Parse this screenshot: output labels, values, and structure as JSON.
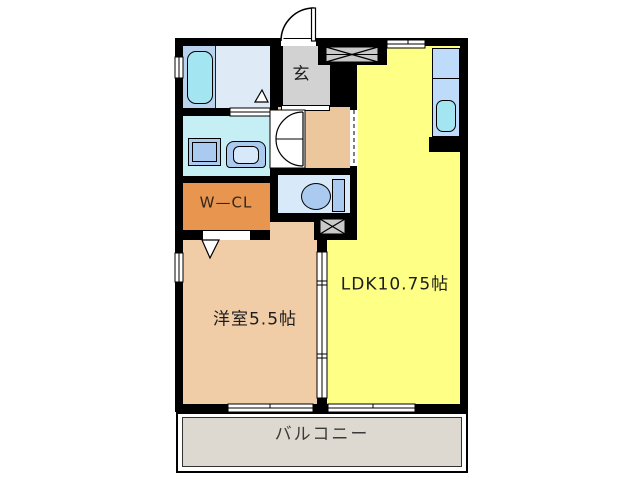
{
  "plan": {
    "type": "apartment-floor-plan",
    "wall_color": "#000000",
    "rooms": {
      "entrance": {
        "label": "玄",
        "color": "#d2d2d2"
      },
      "ldk": {
        "label": "LDK10.75帖",
        "color": "#feff85"
      },
      "western_room": {
        "label": "洋室5.5帖",
        "color": "#f0cda7"
      },
      "walk_in_closet": {
        "label": "W—CL",
        "color": "#e7954f"
      },
      "balcony": {
        "label": "バルコニー",
        "color": "#ded9d0"
      },
      "bathroom": {
        "label": "",
        "color": "#b9d3ee"
      },
      "washroom": {
        "label": "",
        "color": "#c6eef5"
      },
      "toilet": {
        "label": "",
        "color": "#d8e9f9"
      },
      "hallway": {
        "label": "",
        "color": "#ecc79d"
      }
    },
    "fixtures": [
      "bathtub",
      "washing-machine",
      "washbasin",
      "toilet-bowl",
      "kitchen-counter",
      "kitchen-sink",
      "entrance-swing-door",
      "double-doors",
      "sliding-partition",
      "sliding-windows",
      "vent-x-window",
      "pipe-space-vent",
      "door-direction-triangles"
    ]
  }
}
